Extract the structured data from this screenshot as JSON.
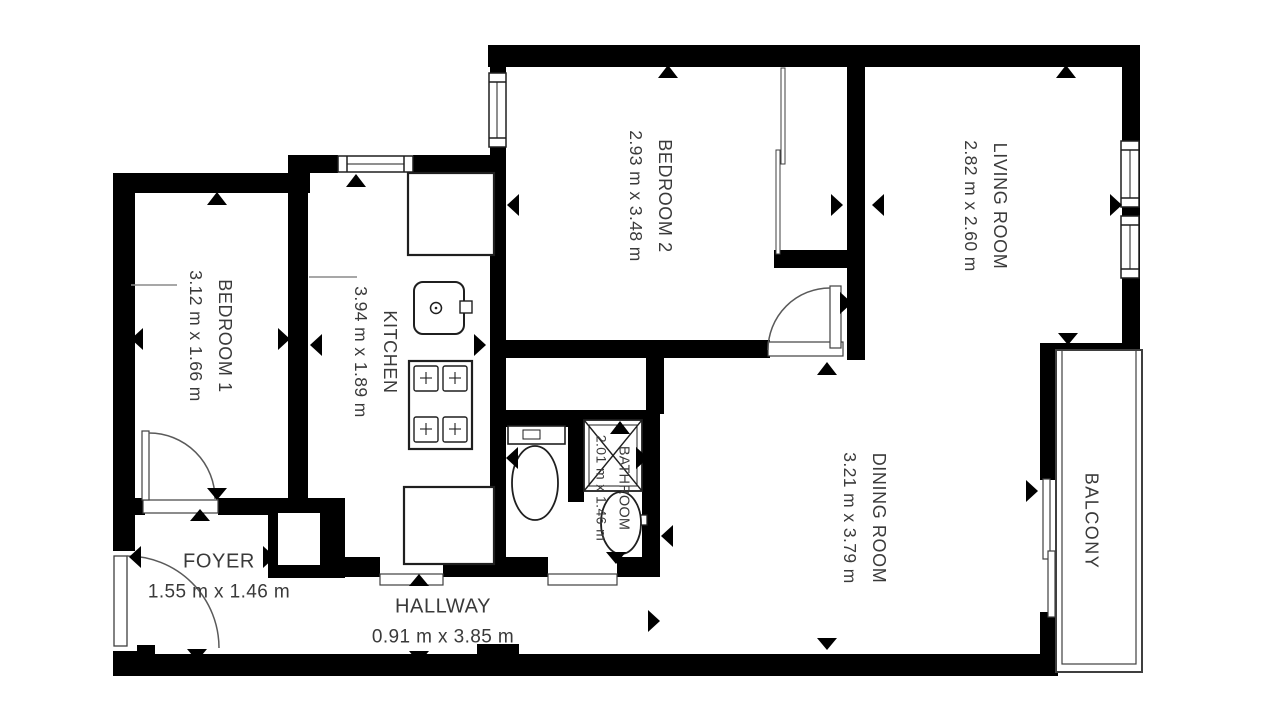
{
  "colors": {
    "wall": "#000000",
    "text": "#3a3a3a",
    "fixture_line": "#1f1f1f",
    "thin_line": "#3f3f3f",
    "door_arc": "#5a5a5a",
    "background": "#ffffff"
  },
  "rooms": {
    "bedroom1": {
      "name": "BEDROOM 1",
      "dims": "3.12 m x 1.66 m"
    },
    "kitchen": {
      "name": "KITCHEN",
      "dims": "3.94 m x 1.89 m"
    },
    "bedroom2": {
      "name": "BEDROOM 2",
      "dims": "2.93 m x 3.48 m"
    },
    "living_room": {
      "name": "LIVING ROOM",
      "dims": "2.82 m x 2.60 m"
    },
    "dining_room": {
      "name": "DINING ROOM",
      "dims": "3.21 m x 3.79 m"
    },
    "bathroom": {
      "name": "BATHROOM",
      "dims": "2.01 m x 1.46 m"
    },
    "foyer": {
      "name": "FOYER",
      "dims": "1.55 m x 1.46 m"
    },
    "hallway": {
      "name": "HALLWAY",
      "dims": "0.91 m x 3.85 m"
    },
    "balcony": {
      "name": "BALCONY",
      "dims": ""
    }
  },
  "icons": {
    "door-swing-icon": "quarter-circle-arc",
    "window-icon": "double-pane-lines",
    "dimension-arrow-icon": "filled-black-triangle",
    "toilet-icon": "tank-and-bowl",
    "kitchen-sink-icon": "rounded-square-with-drain-circle",
    "stove-icon": "four-burner-grid",
    "shower-icon": "square-with-x-cross",
    "bathroom-sink-icon": "oval-basin-with-tap",
    "sliding-door-icon": "offset-double-lines"
  }
}
